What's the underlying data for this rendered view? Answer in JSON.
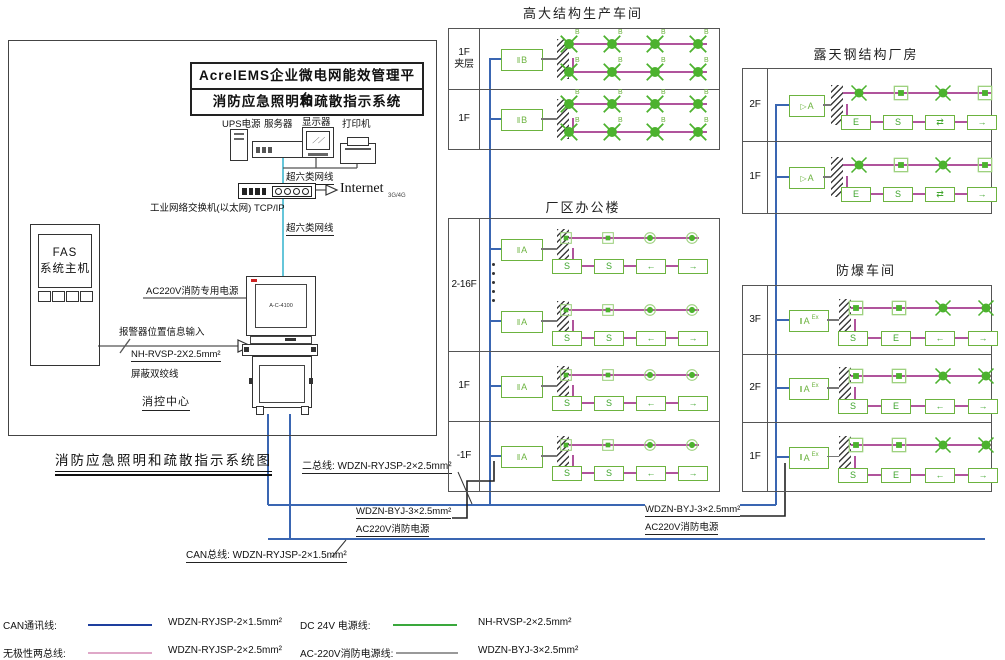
{
  "diagram": {
    "main_title": "消防应急照明和疏散指示系统图",
    "platform_line1": "AcrelEMS企业微电网能效管理平台",
    "platform_line2": "消防应急照明和疏散指示系统",
    "equipment": {
      "ups": "UPS电源",
      "server": "服务器",
      "display": "显示器",
      "printer": "打印机"
    },
    "network": {
      "cable_top": "超六类网线",
      "cable_bottom": "超六类网线",
      "switch_label": "工业网络交换机(以太网) TCP/IP",
      "internet": "Internet",
      "internet_note": "3G/4G"
    },
    "fas": {
      "name_line1": "FAS",
      "name_line2": "系统主机"
    },
    "control_room": {
      "power": "AC220V消防专用电源",
      "screen": "A-C-4100",
      "alarm_input": "报警器位置信息输入",
      "alarm_cable": "NH-RVSP-2X2.5mm²",
      "alarm_wire": "屏蔽双绞线",
      "name": "消控中心"
    },
    "bus_labels": {
      "two_bus": "二总线: WDZN-RYJSP-2×2.5mm²",
      "can_bus": "CAN总线: WDZN-RYJSP-2×1.5mm²",
      "ac_cable_left": "WDZN-BYJ-3×2.5mm²",
      "ac_name_left": "AC220V消防电源",
      "ac_cable_right": "WDZN-BYJ-3×2.5mm²",
      "ac_name_right": "AC220V消防电源"
    }
  },
  "buildings": [
    {
      "id": "tall_workshop",
      "name": "高大结构生产车间",
      "floors": [
        {
          "label": "1F\n夹层",
          "groups": 1
        },
        {
          "label": "1F",
          "groups": 1
        }
      ],
      "device": {
        "prefix": "‖",
        "letter": "B",
        "sup": ""
      },
      "top": {
        "kind": "lamps",
        "items": [
          "cx",
          "cx",
          "cx",
          "cx"
        ],
        "sup": "B"
      },
      "bottom": {
        "kind": "lamps",
        "items": [
          "cx",
          "cx",
          "cx",
          "cx"
        ],
        "sup": "B"
      }
    },
    {
      "id": "office",
      "name": "厂区办公楼",
      "floors": [
        {
          "label": "2-16F",
          "groups": 2,
          "ellipsis": true
        },
        {
          "label": "1F",
          "groups": 1
        },
        {
          "label": "-1F",
          "groups": 1
        }
      ],
      "device": {
        "prefix": "‖",
        "letter": "A",
        "sup": ""
      },
      "top": {
        "kind": "lamps",
        "items": [
          "sq",
          "sq",
          "ci",
          "ci"
        ],
        "sup": ""
      },
      "bottom": {
        "kind": "signs",
        "items": [
          "S",
          "S",
          "←",
          "→"
        ]
      }
    },
    {
      "id": "steel_plant",
      "name": "露天钢结构厂房",
      "floors": [
        {
          "label": "2F",
          "groups": 1
        },
        {
          "label": "1F",
          "groups": 1
        }
      ],
      "device": {
        "prefix": "▷",
        "letter": "A",
        "sup": ""
      },
      "top": {
        "kind": "lamps",
        "items": [
          "cx",
          "sq",
          "cx",
          "sq"
        ],
        "sup": ""
      },
      "bottom": {
        "kind": "signs",
        "items": [
          "E",
          "S",
          "⇄",
          "→"
        ]
      }
    },
    {
      "id": "explosion_proof",
      "name": "防爆车间",
      "floors": [
        {
          "label": "3F",
          "groups": 1
        },
        {
          "label": "2F",
          "groups": 1
        },
        {
          "label": "1F",
          "groups": 1
        }
      ],
      "device": {
        "prefix": "‖",
        "letter": "A",
        "sup": "Ex"
      },
      "top": {
        "kind": "lamps",
        "items": [
          "sq",
          "sq",
          "cx",
          "cx"
        ],
        "sup": ""
      },
      "bottom": {
        "kind": "signs",
        "items": [
          "S",
          "E",
          "←",
          "→"
        ]
      }
    }
  ],
  "legend": [
    {
      "name": "CAN通讯线:",
      "cable": "WDZN-RYJSP-2×1.5mm²",
      "color": "#1e3f9e"
    },
    {
      "name": "DC 24V 电源线:",
      "cable": "NH-RVSP-2×2.5mm²",
      "color": "#3aa83c"
    },
    {
      "name": "无极性两总线:",
      "cable": "WDZN-RYJSP-2×2.5mm²",
      "color": "#dfa8c8"
    },
    {
      "name": "AC-220V消防电源线:",
      "cable": "WDZN-BYJ-3×2.5mm²",
      "color": "#999999"
    }
  ],
  "colors": {
    "bus_blue": "#3a66b2",
    "run_magenta": "#b0549c",
    "device_green": "#6cb33f",
    "lamp_green": "#4cb22e",
    "lamp_light_green": "#9ed17f",
    "cyan": "#66c6da",
    "black_wire": "#222222"
  }
}
